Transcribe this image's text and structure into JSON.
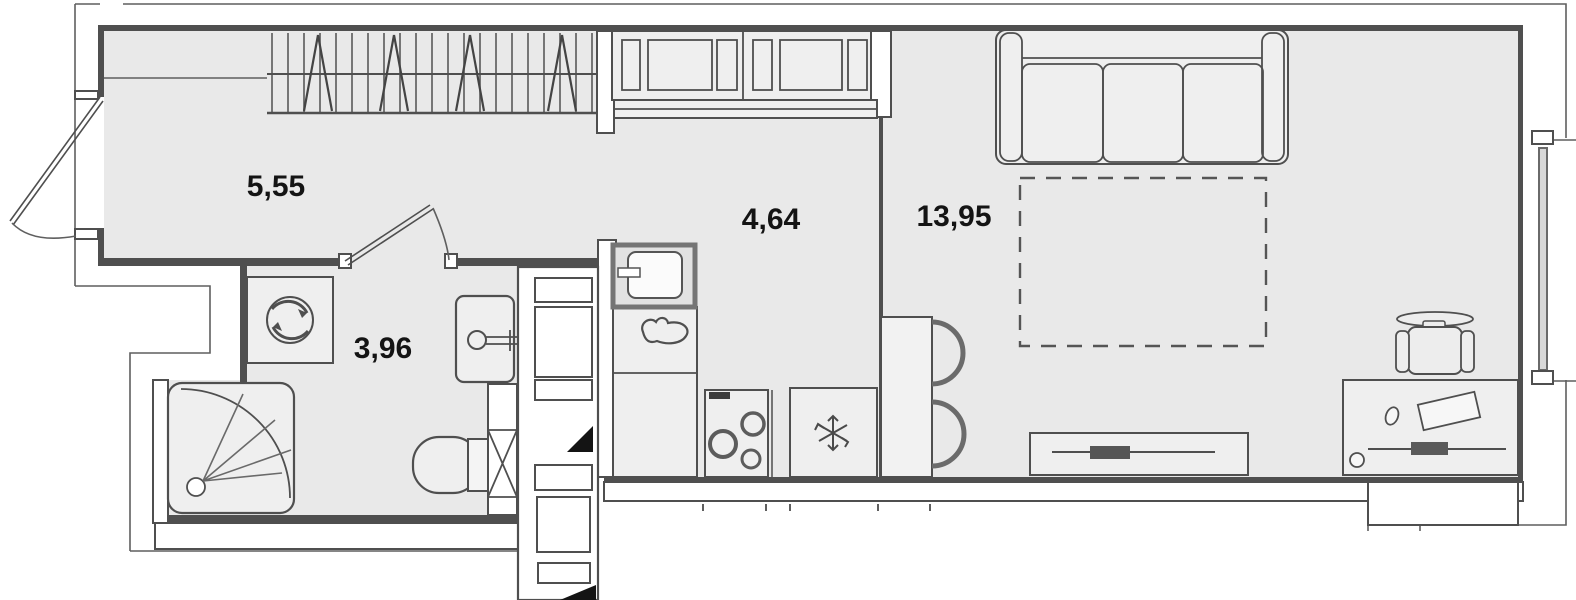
{
  "plan": {
    "type": "apartment-floor-plan",
    "rooms": [
      {
        "id": "hallway",
        "area_label": "5,55"
      },
      {
        "id": "kitchen",
        "area_label": "4,64"
      },
      {
        "id": "living-room",
        "area_label": "13,95"
      },
      {
        "id": "bathroom",
        "area_label": "3,96"
      }
    ],
    "colors": {
      "background": "#ffffff",
      "floor": "#e9e9e9",
      "furniture_fill": "#efefef",
      "wall_fill": "#ffffff",
      "wall_stroke": "#4f4f4f",
      "contour_stroke": "#5f5f5f",
      "label": "#141414",
      "vent_marker": "#141414"
    },
    "fixtures": [
      "entrance-door",
      "wardrobe",
      "kitchen-wall-cabinets",
      "kitchen-sink",
      "kitchen-faucet",
      "stove",
      "fridge",
      "bar-table",
      "bar-stools",
      "sofa",
      "sofa-bed-zone",
      "tv-stand",
      "desk",
      "office-chair",
      "washing-machine",
      "shower",
      "bathroom-sink",
      "toilet",
      "ventilation-shaft",
      "window"
    ]
  }
}
